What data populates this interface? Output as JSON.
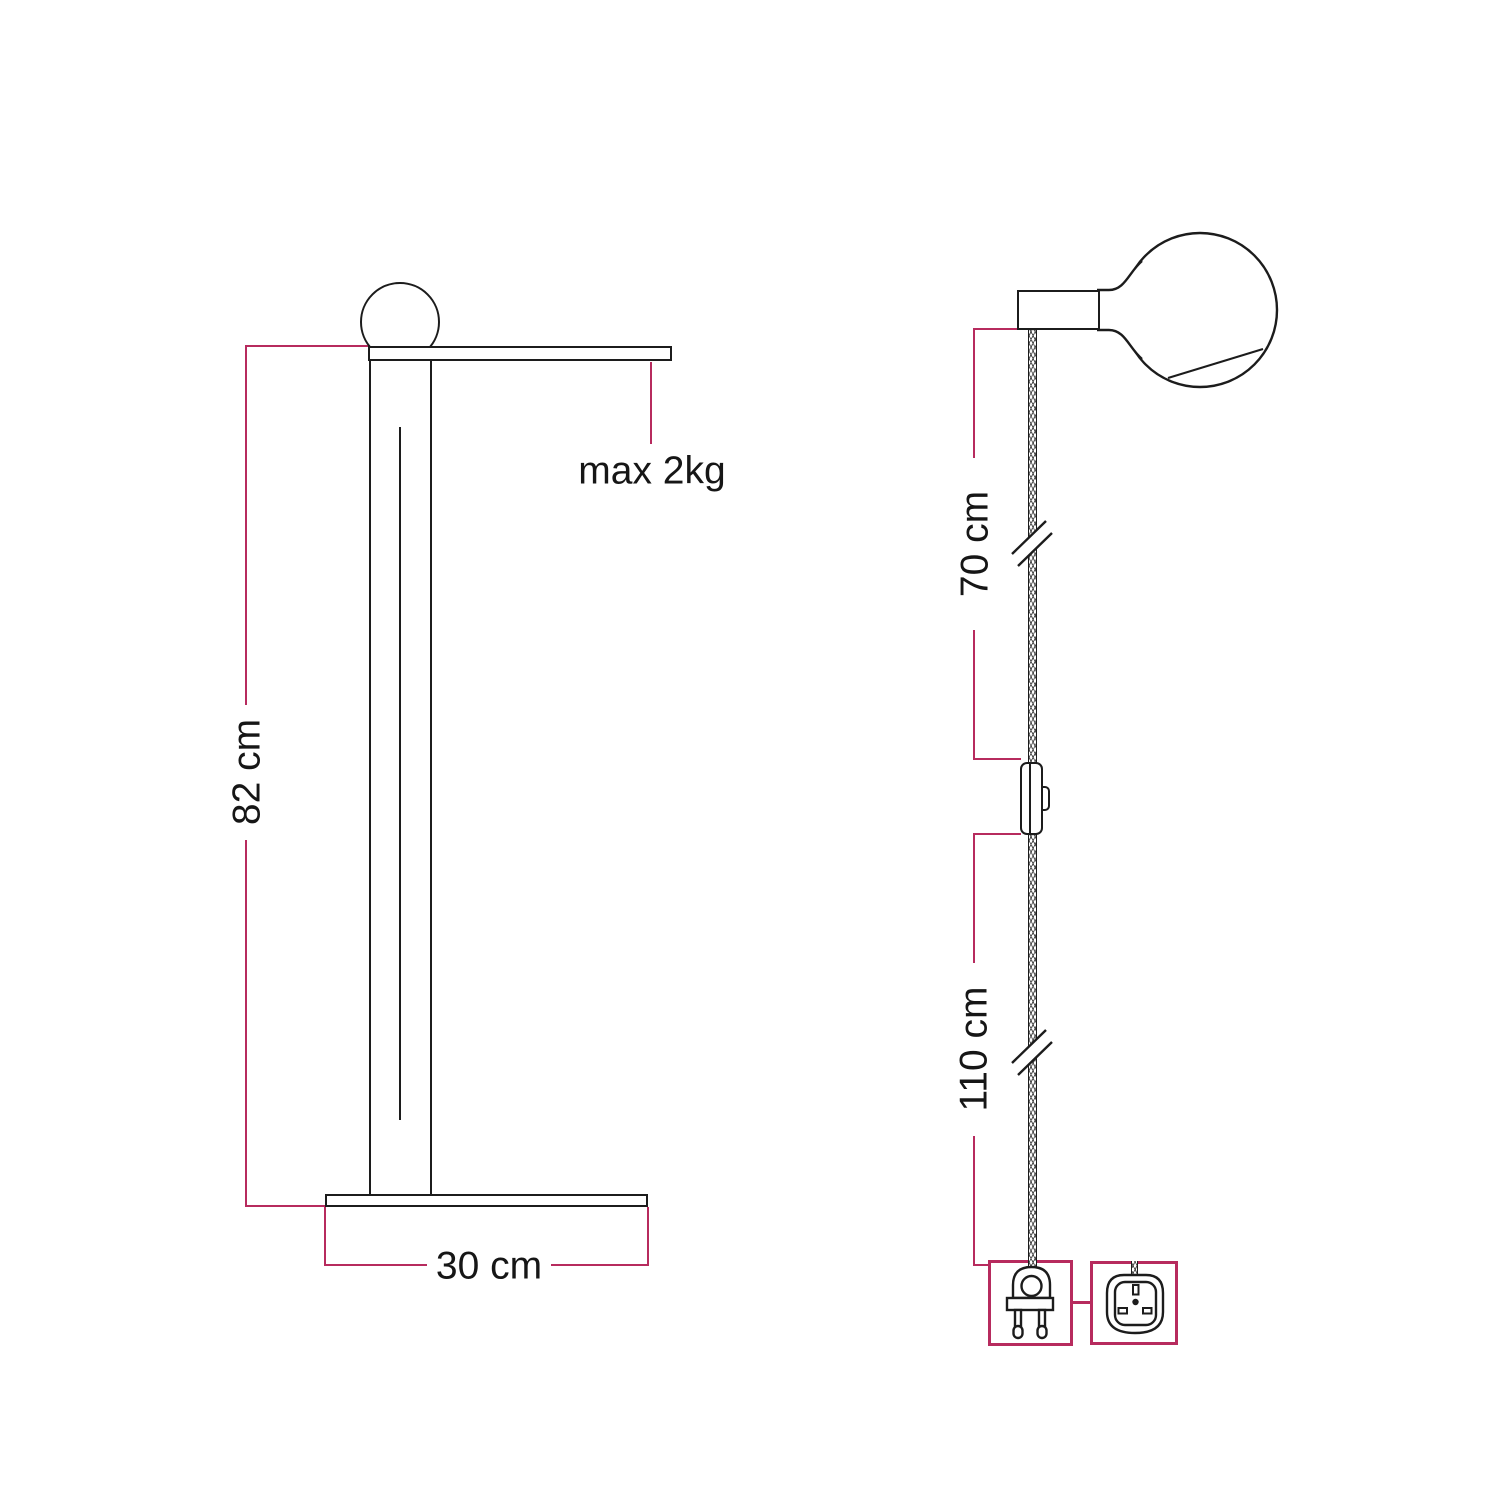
{
  "colors": {
    "background": "#ffffff",
    "ink": "#1c1c1c",
    "dimension_accent": "#b72b5e"
  },
  "front_view": {
    "height_label": "82 cm",
    "base_width_label": "30 cm",
    "max_load_label": "max 2kg",
    "icons": [
      "globe-bulb-icon",
      "lamp-arm",
      "lamp-pole",
      "lamp-base"
    ]
  },
  "side_view": {
    "upper_cord_label": "70 cm",
    "lower_cord_label": "110 cm",
    "icons": [
      "lamp-socket",
      "globe-bulb-icon",
      "braided-cord",
      "cord-break-mark",
      "inline-switch-icon",
      "two-pin-plug-icon",
      "uk-plug-icon"
    ]
  }
}
